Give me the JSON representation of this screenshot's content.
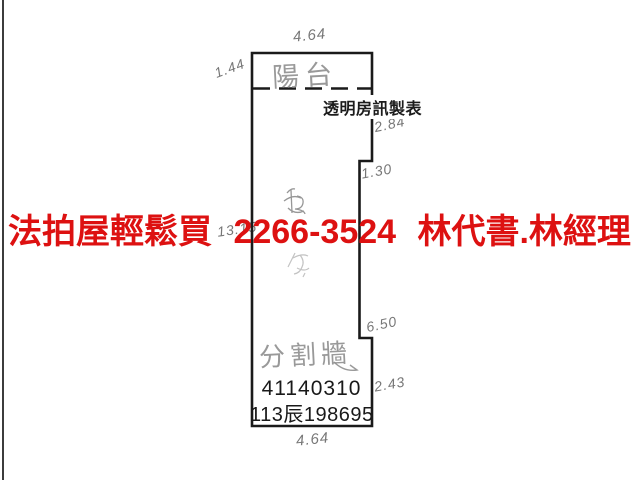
{
  "ad_banner": {
    "text": "法拍屋輕鬆買 2266-3524 林代書.林經理",
    "color": "#dd1111"
  },
  "floor_plan": {
    "maker_label": "透明房訊製表",
    "registration_number": "41140310",
    "case_number": "113辰198695",
    "labels": {
      "balcony": "陽台",
      "partition_wall": "分割牆"
    },
    "dimensions": {
      "top_width": "4.64",
      "balcony_depth": "1.44",
      "right_upper": "2.84",
      "right_step": "1.30",
      "right_lower": "6.50",
      "right_bottom": "2.43",
      "left_height": "13.15",
      "bottom_width": "4.64"
    },
    "line_color": "#1a1a1a"
  }
}
